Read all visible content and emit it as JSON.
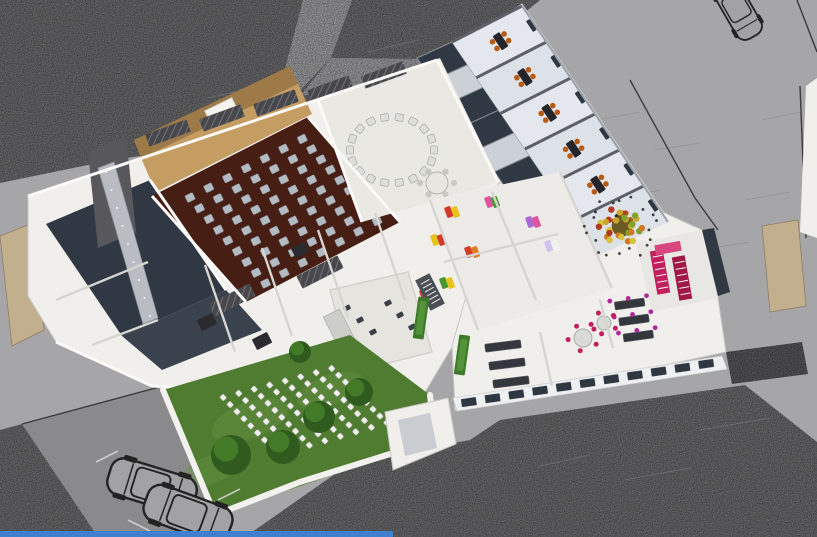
{
  "meta": {
    "description": "Axonometric 3D cutaway rendering of a cultural-center floor plan: auditorium with seat rows, circular meeting room, classroom wing with orange chairs, art rooms with colorful wall posters, magenta staircase, event garden with white chair rows, streets, parking and cars",
    "image_type": "architectural-render",
    "text_present": false
  },
  "counts": {
    "auditorium_seats": 63,
    "circle_chairs": 18,
    "circle_table_chairs": 6,
    "garden_chairs": 72,
    "wing_classrooms": 6,
    "wall_posters": 8,
    "garden_trees": 5,
    "cars": 3
  },
  "palette": {
    "road_light": "#a6a5a7",
    "asphalt": "#707072",
    "pavement_dark": "#8a8a8c",
    "wall_white": "#f0efeb",
    "floor_cream": "#eae8e2",
    "floor_cool": "#dde1e8",
    "floor_dark": "#303844",
    "aud_floor": "#461e13",
    "wood": "#c59c61",
    "wood_dark": "#9d7a48",
    "seat": "#b3bac2",
    "chair_white": "#dedfdb",
    "orange": "#b85a12",
    "table_dark": "#26262a",
    "magenta": "#c21f5e",
    "magenta_dark": "#a11848",
    "pink_light": "#d8487e",
    "glass": "#2f3742",
    "grass": "#4f7c31",
    "grass_light": "#639140",
    "tree": "#2f5c1e",
    "tree_light": "#477f2a",
    "stone": "#c2af8e",
    "roof_dark": "#48484c",
    "board": "#2b2b2f",
    "metal": "#4a4e55",
    "blue_strip": "#3f7fd0"
  },
  "scene": {
    "polys": {
      "asphalt_top": "0,0 540,0 472,56 437,62 330,92 240,142 112,160 0,183",
      "asphalt_bottom": "245,537 345,467 432,447 470,440 500,420 745,385 817,442 817,537",
      "asphalt_left": "0,430 22,424 98,537 0,537",
      "parking": "22,424 163,386 215,514 236,537 98,537",
      "path_top": "303,0 352,0 331,58 262,131 240,142 282,80",
      "path_branch": "331,58 433,59 437,73 300,96",
      "hedge": "726,352 802,342 808,374 732,384",
      "sliver_right": "806,86 817,78 817,238 800,232",
      "stone_left": "0,236 30,224 44,330 12,346",
      "stone_right": "762,226 798,220 806,306 770,312",
      "mass_left": "28,196 437,60 500,182 455,342 418,404 152,386 56,342 28,296",
      "mass_right": "452,346 498,184 558,164 702,230 718,298 726,352 455,410",
      "mass_wing": "437,60 522,4 670,222 600,260 498,182",
      "mass_utility": "385,412 448,398 456,444 393,470",
      "left_dark1": "46,224 150,180 226,290 122,336",
      "left_dark2": "122,336 226,290 262,330 162,370",
      "tower": "88,152 126,136 136,232 98,248",
      "ramp": "98,168 114,162 158,318 143,324",
      "stage_back": "134,140 290,66 298,84 141,158",
      "stage": "141,158 298,84 312,114 156,192",
      "aud_floor": "152,196 308,117 400,222 246,302",
      "circle_room": "318,100 440,58 500,182 362,222",
      "art_room": "430,200 560,172 612,288 478,330",
      "bath_room": "330,290 408,272 432,352 352,372",
      "stair_room": "636,243 702,230 718,298 652,312",
      "dark_room_right": "702,230 714,228 730,292 718,296",
      "facade_band": "453,398 722,356 727,369 457,411",
      "lawn": "163,390 350,335 430,395 435,440 215,515"
    },
    "paths": {
      "garden_wall": "M163,390 L215,515 L300,482 L435,440 L430,395"
    },
    "auditorium": {
      "quad": [
        [
          176,
          197
        ],
        [
          307,
          129
        ],
        [
          391,
          221
        ],
        [
          261,
          294
        ]
      ],
      "cols": 7,
      "rows": 9,
      "angle": -26
    },
    "circle": {
      "cx": 392,
      "cy": 150,
      "rx": 42,
      "ry": 33,
      "count": 18,
      "tx": 437,
      "ty": 183,
      "tr": 11
    },
    "wing": {
      "outer": [
        [
          522,
          6
        ],
        [
          668,
          222
        ]
      ],
      "inner": [
        [
          452,
          42
        ],
        [
          598,
          256
        ]
      ],
      "count": 6
    },
    "corridor": {
      "outer": [
        [
          452,
          42
        ],
        [
          598,
          256
        ]
      ],
      "inner": [
        [
          417,
          58
        ],
        [
          563,
          272
        ]
      ],
      "count": 8,
      "tmax": 0.85,
      "dark": [
        0,
        2,
        3,
        5
      ]
    },
    "garden_chairs": {
      "quad": [
        [
          212,
          396
        ],
        [
          336,
          363
        ],
        [
          398,
          424
        ],
        [
          274,
          460
        ]
      ],
      "cols": 8,
      "rows": 9,
      "angle": 46
    },
    "trees": [
      [
        231,
        455,
        20
      ],
      [
        283,
        447,
        17
      ],
      [
        319,
        417,
        16
      ],
      [
        359,
        392,
        14
      ],
      [
        300,
        352,
        11
      ]
    ],
    "posters": [
      [
        452,
        212,
        "#d23b2a",
        "#e8c21e"
      ],
      [
        492,
        202,
        "#e055a0",
        "#47992e"
      ],
      [
        533,
        222,
        "#a86bd4",
        "#e055a0"
      ],
      [
        552,
        246,
        "#cfc3ee",
        "#f2f2f2"
      ],
      [
        472,
        252,
        "#d23b2a",
        "#e07c1e"
      ],
      [
        438,
        240,
        "#e8c21e",
        "#d23b2a"
      ],
      [
        447,
        283,
        "#47992e",
        "#e8c21e"
      ],
      [
        427,
        295,
        "#d23b2a",
        "#e8c21e"
      ]
    ],
    "desk_rooms": [
      {
        "quad": [
          [
            462,
            342
          ],
          [
            540,
            332
          ],
          [
            552,
            386
          ],
          [
            474,
            396
          ]
        ],
        "desks": 3,
        "angle": -7,
        "w": 36
      },
      {
        "quad": [
          [
            600,
            300
          ],
          [
            655,
            292
          ],
          [
            668,
            340
          ],
          [
            613,
            348
          ]
        ],
        "desks": 3,
        "angle": -8,
        "w": 30,
        "chair": "#b0299c"
      }
    ],
    "dining": [
      [
        583,
        338,
        9
      ],
      [
        604,
        323,
        7
      ]
    ],
    "facade": {
      "a": [
        457,
        404
      ],
      "b": [
        718,
        362
      ],
      "count": 11,
      "angle": -8
    },
    "hatches": [
      [
        168,
        133,
        44,
        13,
        -20
      ],
      [
        222,
        118,
        44,
        13,
        -20
      ],
      [
        276,
        103,
        44,
        13,
        -20
      ],
      [
        330,
        89,
        44,
        13,
        -20
      ],
      [
        384,
        75,
        44,
        13,
        -20
      ],
      [
        232,
        300,
        46,
        14,
        -27
      ],
      [
        320,
        272,
        46,
        14,
        -27
      ]
    ],
    "boards": [
      [
        207,
        322,
        17,
        12,
        -27
      ],
      [
        262,
        341,
        17,
        12,
        -27
      ],
      [
        300,
        250,
        15,
        11,
        -27
      ]
    ],
    "green_walls": [
      [
        421,
        318,
        11,
        42,
        8
      ],
      [
        462,
        355,
        11,
        40,
        8
      ]
    ],
    "bath_fixtures": [
      [
        347,
        308
      ],
      [
        360,
        320
      ],
      [
        373,
        332
      ],
      [
        388,
        303
      ],
      [
        400,
        315
      ],
      [
        412,
        327
      ]
    ],
    "stair_steps": [
      [
        657,
        253,
        664,
        291,
        6
      ],
      [
        679,
        259,
        686,
        297,
        6
      ],
      [
        424,
        280,
        437,
        303,
        6
      ]
    ],
    "ramp_dots": {
      "a": [
        106,
        172
      ],
      "b": [
        150,
        316
      ],
      "n": 9
    },
    "courtyard_tree": {
      "x": 622,
      "y": 226,
      "r": 26,
      "colors": [
        "#c9a92c",
        "#cf7a1f",
        "#b23a20",
        "#7fa32c",
        "#d9c13a"
      ]
    },
    "cars": [
      [
        737,
        8,
        240,
        1.0
      ],
      [
        152,
        486,
        197,
        1.35
      ],
      [
        188,
        514,
        200,
        1.35
      ]
    ],
    "walls_white": [
      [
        152,
        196,
        246,
        302
      ],
      [
        308,
        117,
        400,
        222
      ],
      [
        318,
        100,
        362,
        222
      ],
      [
        150,
        180,
        226,
        290
      ],
      [
        437,
        60,
        498,
        182
      ],
      [
        56,
        342,
        152,
        386
      ],
      [
        152,
        386,
        418,
        404
      ],
      [
        28,
        196,
        437,
        60
      ]
    ],
    "walls_gray": [
      [
        205,
        265,
        235,
        352
      ],
      [
        262,
        248,
        292,
        336
      ],
      [
        318,
        230,
        348,
        318
      ],
      [
        375,
        213,
        405,
        300
      ],
      [
        492,
        192,
        536,
        300
      ],
      [
        444,
        262,
        558,
        234
      ],
      [
        56,
        300,
        148,
        262
      ],
      [
        92,
        345,
        158,
        320
      ],
      [
        540,
        332,
        552,
        386
      ],
      [
        600,
        300,
        613,
        348
      ],
      [
        560,
        172,
        612,
        288
      ],
      [
        398,
        418,
        428,
        411
      ],
      [
        430,
        200,
        478,
        330
      ]
    ],
    "boundary_lines": [
      [
        630,
        80,
        695,
        198
      ],
      [
        695,
        198,
        718,
        230
      ],
      [
        797,
        0,
        817,
        52
      ],
      [
        22,
        424,
        163,
        386
      ],
      [
        800,
        86,
        806,
        238
      ]
    ],
    "sketch_lines": [
      [
        598,
        120,
        640,
        112
      ],
      [
        655,
        150,
        700,
        143
      ],
      [
        612,
        200,
        660,
        190
      ],
      [
        700,
        250,
        750,
        242
      ],
      [
        672,
        300,
        720,
        290
      ],
      [
        745,
        200,
        790,
        192
      ],
      [
        762,
        120,
        800,
        112
      ],
      [
        580,
        330,
        625,
        322
      ],
      [
        700,
        430,
        770,
        418
      ],
      [
        540,
        466,
        590,
        455
      ],
      [
        624,
        480,
        690,
        468
      ],
      [
        368,
        52,
        418,
        40
      ],
      [
        208,
        98,
        262,
        86
      ]
    ],
    "parking_lines": [
      [
        118,
        451,
        96,
        462
      ],
      [
        240,
        489,
        218,
        500
      ],
      [
        150,
        531,
        128,
        520
      ]
    ]
  }
}
